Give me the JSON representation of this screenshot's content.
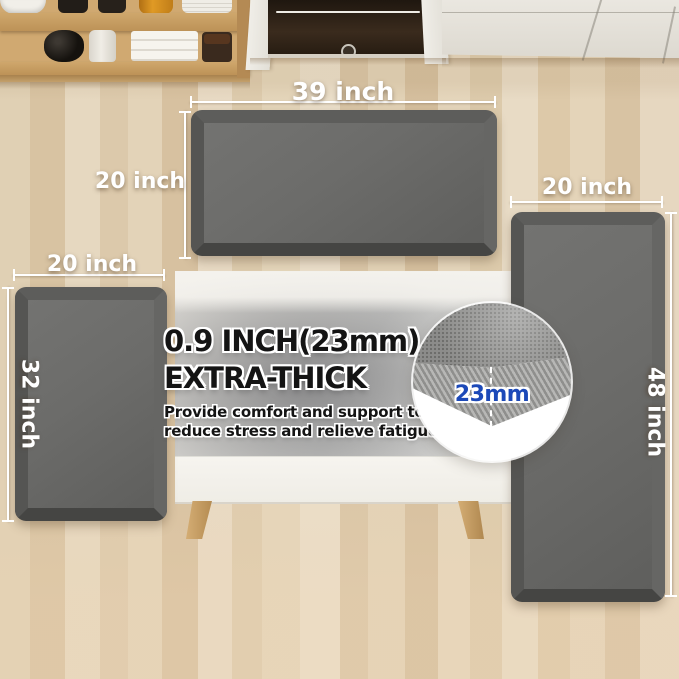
{
  "labels": {
    "top_mat_width": "39 inch",
    "top_mat_height": "20 inch",
    "left_mat_width": "20 inch",
    "left_mat_height": "32 inch",
    "right_mat_width": "20 inch",
    "right_mat_height": "48 inch"
  },
  "callout": {
    "headline_line1": "0.9 INCH(23mm)",
    "headline_line2": "EXTRA-THICK",
    "body_line1": "Provide comfort and support to",
    "body_line2": "reduce stress and relieve fatigue.",
    "inset_measurement": "23mm"
  },
  "colors": {
    "mat_face": "#6c6c6a",
    "dimension_text": "#ffffff",
    "headline_text": "#141414",
    "inset_text": "#1c49b8",
    "floor_base": "#e3d4ba",
    "cabinet": "#e8e5de",
    "shelf_wood": "#c79c61"
  }
}
